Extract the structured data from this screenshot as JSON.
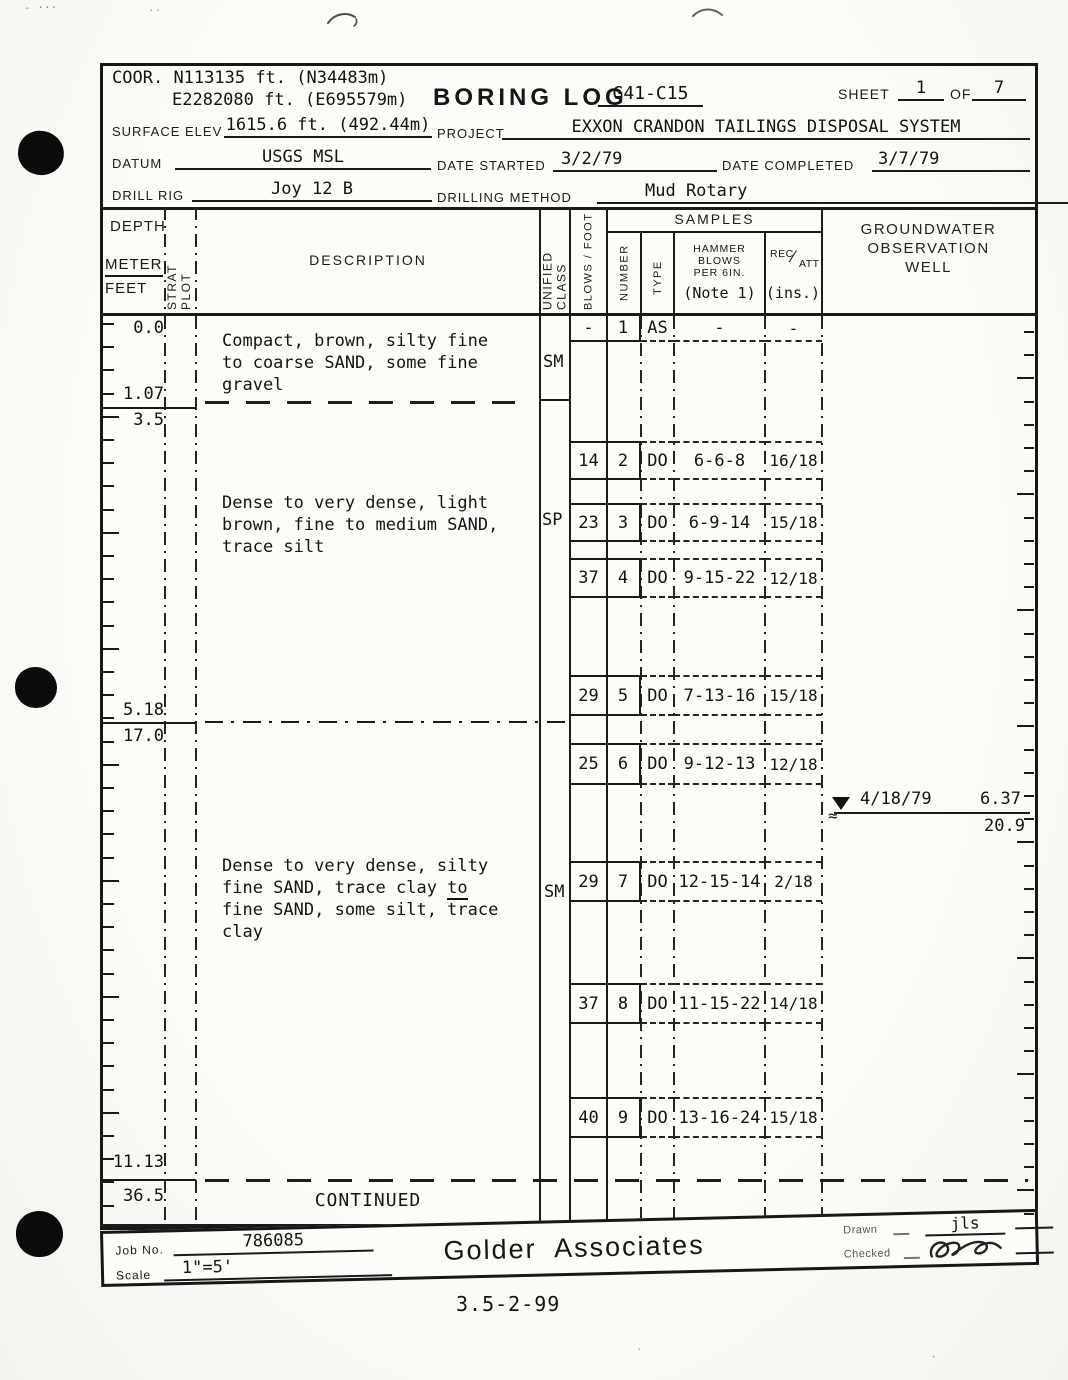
{
  "header": {
    "coor_label": "COOR.",
    "coor_line1": "N113135 ft. (N34483m)",
    "coor_line2": "E2282080 ft. (E695579m)",
    "title": "BORING LOG",
    "boring_id": "G41-C15",
    "sheet_label": "SHEET",
    "sheet_no": "1",
    "of_label": "OF",
    "sheet_total": "7",
    "surface_elev_label": "SURFACE ELEV",
    "surface_elev": "1615.6 ft. (492.44m)",
    "project_label": "PROJECT",
    "project": "EXXON CRANDON TAILINGS DISPOSAL SYSTEM",
    "datum_label": "DATUM",
    "datum": "USGS MSL",
    "date_started_label": "DATE STARTED",
    "date_started": "3/2/79",
    "date_completed_label": "DATE COMPLETED",
    "date_completed": "3/7/79",
    "drill_rig_label": "DRILL RIG",
    "drill_rig": "Joy 12 B",
    "drilling_method_label": "DRILLING METHOD",
    "drilling_method": "Mud Rotary"
  },
  "columns": {
    "depth": "DEPTH",
    "meter": "METER",
    "feet": "FEET",
    "strat_plot": "STRAT PLOT",
    "description": "DESCRIPTION",
    "unified_class": "UNIFIED CLASS",
    "blows_foot": "BLOWS / FOOT",
    "samples": "SAMPLES",
    "number": "NUMBER",
    "type": "TYPE",
    "hammer_l1": "HAMMER",
    "hammer_l2": "BLOWS",
    "hammer_l3": "PER 6IN.",
    "hammer_note": "(Note 1)",
    "rec": "REC",
    "rec_slash": "⁄",
    "att": "ATT",
    "rec_units": "(ins.)",
    "groundwater_l1": "GROUNDWATER",
    "groundwater_l2": "OBSERVATION",
    "groundwater_l3": "WELL"
  },
  "depth_marks": [
    {
      "meters": "0.0",
      "feet": ""
    },
    {
      "meters": "1.07",
      "feet": "3.5"
    },
    {
      "meters": "5.18",
      "feet": "17.0"
    },
    {
      "meters": "11.13",
      "feet": "36.5"
    }
  ],
  "layers": [
    {
      "unified_class": "SM",
      "description": "Compact, brown, silty fine\nto coarse SAND, some fine\ngravel"
    },
    {
      "unified_class": "SP",
      "description": "Dense to very dense, light\nbrown, fine to medium SAND,\ntrace silt"
    },
    {
      "unified_class": "SM",
      "description_pre": "Dense to very dense, silty\nfine SAND, trace clay ",
      "description_underlined": "to",
      "description_post": "fine SAND, some silt, trace\nclay"
    }
  ],
  "continued_label": "CONTINUED",
  "samples": [
    {
      "blows": "-",
      "number": "1",
      "type": "AS",
      "hammer": "-",
      "rec": "-"
    },
    {
      "blows": "14",
      "number": "2",
      "type": "DO",
      "hammer": "6-6-8",
      "rec": "16/18"
    },
    {
      "blows": "23",
      "number": "3",
      "type": "DO",
      "hammer": "6-9-14",
      "rec": "15/18"
    },
    {
      "blows": "37",
      "number": "4",
      "type": "DO",
      "hammer": "9-15-22",
      "rec": "12/18"
    },
    {
      "blows": "29",
      "number": "5",
      "type": "DO",
      "hammer": "7-13-16",
      "rec": "15/18"
    },
    {
      "blows": "25",
      "number": "6",
      "type": "DO",
      "hammer": "9-12-13",
      "rec": "12/18"
    },
    {
      "blows": "29",
      "number": "7",
      "type": "DO",
      "hammer": "12-15-14",
      "rec": "2/18"
    },
    {
      "blows": "37",
      "number": "8",
      "type": "DO",
      "hammer": "11-15-22",
      "rec": "14/18"
    },
    {
      "blows": "40",
      "number": "9",
      "type": "DO",
      "hammer": "13-16-24",
      "rec": "15/18"
    }
  ],
  "groundwater": {
    "date": "4/18/79",
    "level_m": "6.37",
    "level_ft": "20.9",
    "approx_symbol": "≈"
  },
  "footer": {
    "job_no_label": "Job No.",
    "job_no": "786085",
    "scale_label": "Scale",
    "scale": "1\"=5'",
    "company": "Golder  Associates",
    "drawn_label": "Drawn",
    "drawn_by": "jls",
    "checked_label": "Checked"
  },
  "page": {
    "number": "3.5-2-99"
  }
}
